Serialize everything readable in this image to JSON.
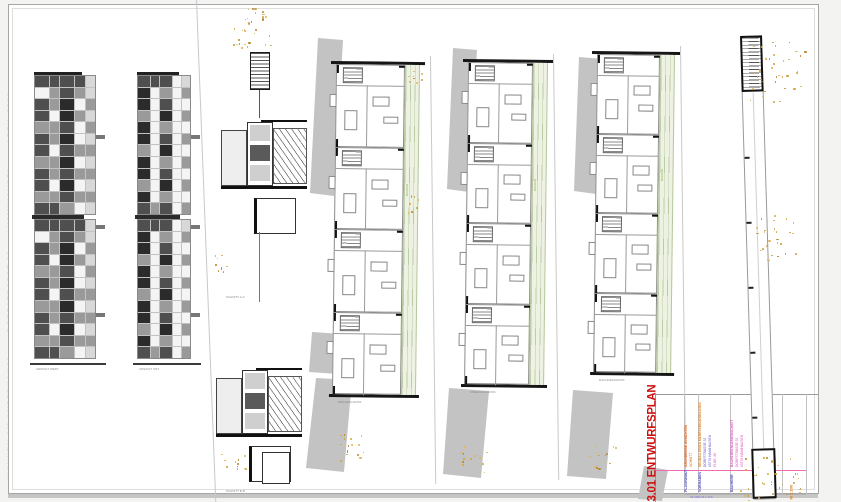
{
  "page": {
    "background": "#f3f3f1",
    "sheet_color": "#ffffff",
    "shadow_color": "#c6c6c4"
  },
  "margin_note": {
    "segments": [
      "WOHNEN AM AMPERKANAL",
      "DORFSTRASSE 32",
      "HAIMHAUSEN",
      "APRIL 2002"
    ],
    "color": "#f0e10a"
  },
  "drawings": {
    "elevation_a_label": "ANSICHT WEST",
    "elevation_b_label": "ANSICHT OST",
    "section_a_label": "SCHNITT A-A",
    "section_b_label": "SCHNITT B-B",
    "plan_labels": [
      "ERDGESCHOSS",
      "OBERGESCHOSS",
      "DACHGESCHOSS"
    ],
    "balcony_label": "BALKON",
    "site_strip_label": "ANSICHT NORD"
  },
  "title_block": {
    "number": "3.01",
    "title": "ENTWURFSPLAN",
    "full_title": "3.01 ENTWURFSPLAN",
    "title_color": "#cc1111",
    "divider_color": "#f06ab4",
    "label_color": "#4743c7",
    "columns": [
      {
        "label": "PLANINHALT",
        "entries": [
          {
            "text": "GRUNDRISSE ANSICHTEN",
            "color": "#e05a10"
          },
          {
            "text": "SCHNITT",
            "color": "#e05a10"
          }
        ]
      },
      {
        "label": "VORHABEN",
        "entries": [
          {
            "text": "NEUBAU EINES MEHRFAMILIENHAUSES",
            "color": "#e07a14"
          },
          {
            "text": "DORFSTRASSE 32",
            "color": "#6a55cc"
          },
          {
            "text": "85778 HAIMHAUSEN",
            "color": "#6a55cc"
          },
          {
            "text": "FLNR. 86",
            "color": "#e052c0"
          }
        ]
      },
      {
        "label": "BAUHERR",
        "entries": [
          {
            "text": "BAUHERRENGEMEINSCHAFT",
            "color": "#e052c0"
          },
          {
            "text": "DORFSTRASSE 32",
            "color": "#e052c0"
          },
          {
            "text": "85778 HAIMHAUSEN",
            "color": "#e052c0"
          }
        ]
      },
      {
        "label": "ARCHITEKT",
        "entries": [
          {
            "text": "ARCHITEKTURBUERO",
            "color": "#e052c0"
          },
          {
            "text": "PLANUNG UND BAULEITUNG",
            "color": "#e052c0"
          },
          {
            "text": "85778 HAIMHAUSEN",
            "color": "#e052c0"
          }
        ]
      },
      {
        "label": "DATUM",
        "entries": [
          {
            "text": "APRIL 2002",
            "color": "#e052c0"
          },
          {
            "text": "INDEX",
            "color": "#e052c0"
          }
        ]
      }
    ],
    "scale_note": {
      "text": "M 1:100",
      "color": "#e07a14"
    },
    "footer_note": {
      "text": "04.2002      M 1:100",
      "color": "#8276d8"
    }
  }
}
